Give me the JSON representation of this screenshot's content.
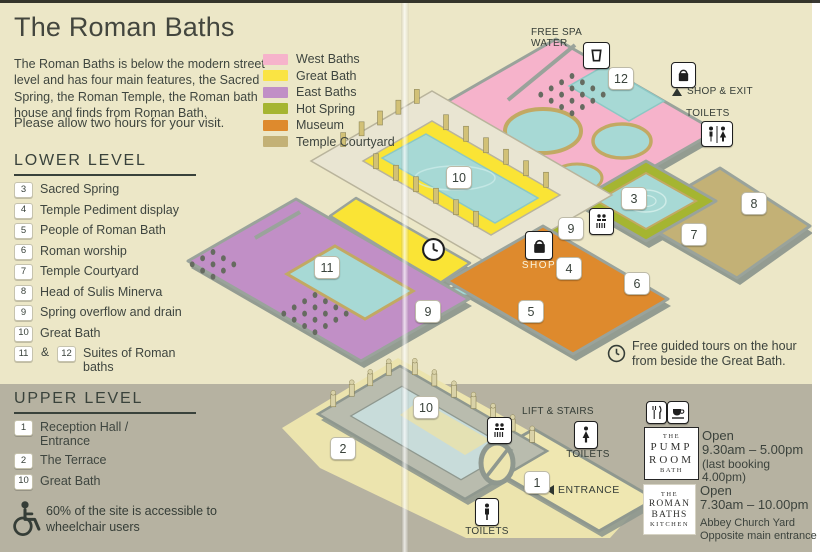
{
  "title": "The Roman Baths",
  "intro": "The Roman Baths is below the modern street level and has four main features, the Sacred Spring, the Roman Temple, the Roman bath house and finds from Roman Bath.",
  "visit_note": "Please allow two hours for your visit.",
  "legend": {
    "items": [
      {
        "label": "West Baths",
        "color": "#F6B3CB"
      },
      {
        "label": "Great Bath",
        "color": "#FAE443"
      },
      {
        "label": "East Baths",
        "color": "#C18FC6"
      },
      {
        "label": "Hot Spring",
        "color": "#A5B531"
      },
      {
        "label": "Museum",
        "color": "#DE8A2D"
      },
      {
        "label": "Temple Courtyard",
        "color": "#C3B176"
      }
    ]
  },
  "lower_level": {
    "heading": "LOWER LEVEL",
    "items": [
      {
        "num": "3",
        "label": "Sacred Spring"
      },
      {
        "num": "4",
        "label": "Temple Pediment display"
      },
      {
        "num": "5",
        "label": "People of Roman Bath"
      },
      {
        "num": "6",
        "label": "Roman worship"
      },
      {
        "num": "7",
        "label": "Temple Courtyard"
      },
      {
        "num": "8",
        "label": "Head of Sulis Minerva"
      },
      {
        "num": "9",
        "label": "Spring overflow and drain"
      },
      {
        "num": "10",
        "label": "Great Bath"
      }
    ],
    "dual_item": {
      "num1": "11",
      "joiner": "&",
      "num2": "12",
      "label": "Suites of Roman baths"
    }
  },
  "upper_level": {
    "heading": "UPPER LEVEL",
    "items": [
      {
        "num": "1",
        "label": "Reception Hall / Entrance"
      },
      {
        "num": "2",
        "label": "The Terrace"
      },
      {
        "num": "10",
        "label": "Great Bath"
      }
    ]
  },
  "accessibility": "60% of the site is accessible to wheelchair users",
  "map": {
    "labels": {
      "free_spa_water": "FREE SPA WATER",
      "shop_exit": "SHOP & EXIT",
      "toilets_top": "TOILETS",
      "shop": "SHOP",
      "lift_stairs": "LIFT & STAIRS",
      "toilets_right": "TOILETS",
      "toilets_bottom": "TOILETS",
      "entrance": "ENTRANCE"
    },
    "lower_markers": [
      "12",
      "10",
      "3",
      "8",
      "9",
      "7",
      "4",
      "6",
      "11",
      "5",
      "9"
    ],
    "upper_markers": [
      "10",
      "2",
      "1"
    ]
  },
  "tours_note": "Free guided tours on the hour from beside the Great Bath.",
  "venues": [
    {
      "logo": [
        "THE",
        "PUMP",
        "ROOM",
        "BATH"
      ],
      "open_label": "Open",
      "hours": "9.30am – 5.00pm",
      "note": "(last booking 4.00pm)"
    },
    {
      "logo": [
        "THE",
        "ROMAN",
        "BATHS",
        "KITCHEN"
      ],
      "open_label": "Open",
      "hours": "7.30am – 10.00pm",
      "address1": "Abbey Church Yard",
      "address2": "Opposite main entrance"
    }
  ]
}
